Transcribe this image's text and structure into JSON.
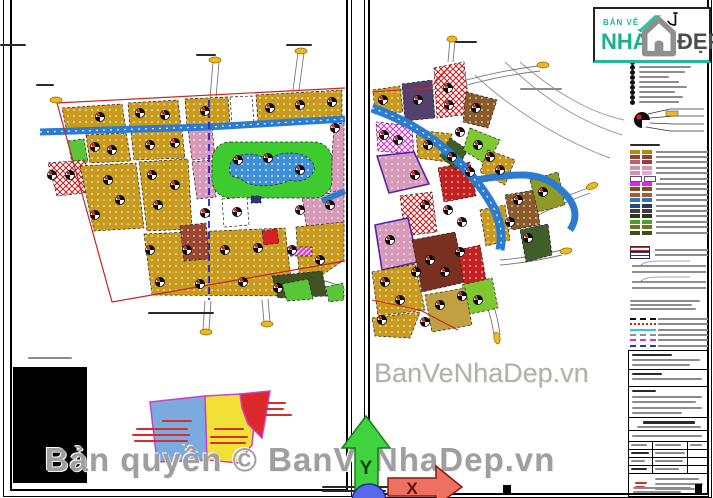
{
  "branding": {
    "tagline": "BẢN VẼ",
    "name_primary": "NHÀ",
    "name_secondary": "ĐẸP"
  },
  "watermarks": {
    "center": "BanVeNhaDep.vn",
    "bottom": "Bản quyền © BanVeNhaDep.vn"
  },
  "axes": {
    "y_label": "Y",
    "x_label": "X"
  },
  "legend": {
    "swatch_rows": [
      {
        "left": "#b8860b",
        "right": "#b8860b"
      },
      {
        "left": "#93422e",
        "right": "#93422e"
      },
      {
        "left": "#b86070",
        "right": "#a03848"
      },
      {
        "left": "#d78fb0",
        "right": "#d78fb0"
      },
      {
        "left": "#d78fb0",
        "right": "#e8a8c8"
      },
      {
        "left": "#ffffff",
        "right": "#ffffff"
      },
      {
        "left": "#e822e8",
        "right": "#e822e8"
      },
      {
        "left": "#8a4a20",
        "right": "#8a4a20"
      },
      {
        "left": "#a85a28",
        "right": "#a85a28"
      },
      {
        "left": "#2878c8",
        "right": "#2878c8"
      },
      {
        "left": "#284888",
        "right": "#283858"
      },
      {
        "left": "#3c3c50",
        "right": "#3c3c50"
      },
      {
        "left": "#2a3818",
        "right": "#2a3818"
      },
      {
        "left": "#4aa028",
        "right": "#4aa028"
      },
      {
        "left": "#6a7a18",
        "right": "#6a7a18"
      },
      {
        "left": "#3a5020",
        "right": "#3a5020"
      }
    ],
    "line_rows": [
      {
        "style": "dashed",
        "color": "#111111"
      },
      {
        "style": "dotted",
        "color": "#d22020"
      },
      {
        "style": "solid",
        "color": "#30c8d8"
      },
      {
        "style": "dashed",
        "color": "#909090"
      },
      {
        "style": "dashed",
        "color": "#d230d2"
      },
      {
        "style": "dashed",
        "color": "#2838a8"
      }
    ]
  },
  "phasing": {
    "zones": [
      {
        "color": "#7babde"
      },
      {
        "color": "#f2e135"
      },
      {
        "color": "#e02828"
      }
    ],
    "outline": "#cc3fcc"
  },
  "map_palette": {
    "residential_olive": "#c89b1e",
    "park_green": "#3ecb2f",
    "water_blue": "#3f8fd8",
    "road_blue": "#2b7cd0",
    "mixed_pink": "#d79ab8",
    "hatch_red": "#cc2020",
    "hatch_magenta": "#e838c8",
    "public_purple": "#55406e",
    "boundary_red": "#d02020"
  }
}
